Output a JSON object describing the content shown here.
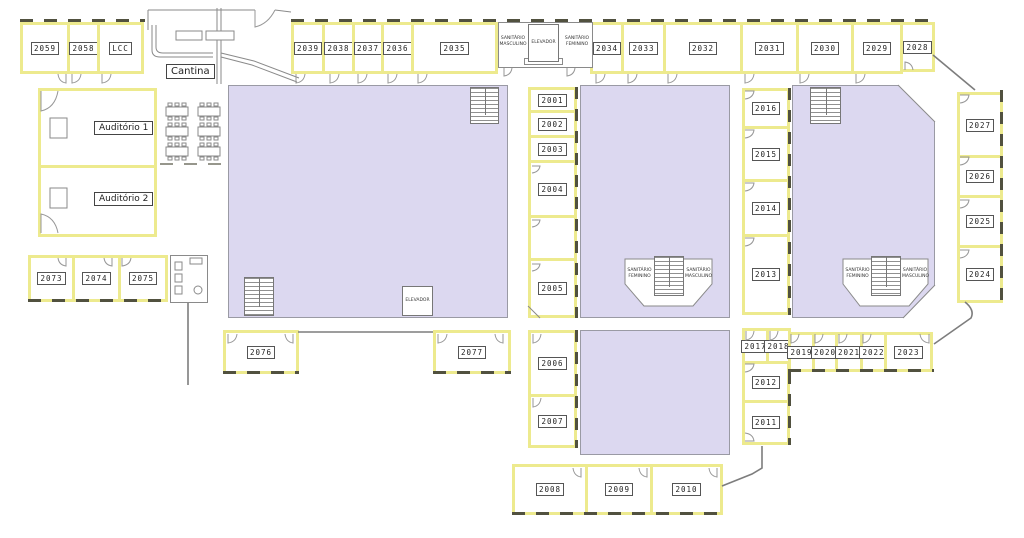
{
  "plan": {
    "rooms": {
      "2001": "2001",
      "2002": "2002",
      "2003": "2003",
      "2004": "2004",
      "2005": "2005",
      "2006": "2006",
      "2007": "2007",
      "2008": "2008",
      "2009": "2009",
      "2010": "2010",
      "2011": "2011",
      "2012": "2012",
      "2013": "2013",
      "2014": "2014",
      "2015": "2015",
      "2016": "2016",
      "2017": "2017",
      "2018": "2018",
      "2019": "2019",
      "2020": "2020",
      "2021": "2021",
      "2022": "2022",
      "2023": "2023",
      "2024": "2024",
      "2025": "2025",
      "2026": "2026",
      "2027": "2027",
      "2028": "2028",
      "2029": "2029",
      "2030": "2030",
      "2031": "2031",
      "2032": "2032",
      "2033": "2033",
      "2034": "2034",
      "2035": "2035",
      "2036": "2036",
      "2037": "2037",
      "2038": "2038",
      "2039": "2039",
      "2058": "2058",
      "2059": "2059",
      "2073": "2073",
      "2074": "2074",
      "2075": "2075",
      "2076": "2076",
      "2077": "2077",
      "lcc": "LCC"
    },
    "areas": {
      "cantina": "Cantina",
      "auditorio1": "Auditório 1",
      "auditorio2": "Auditório 2",
      "elevador": "ELEVADOR",
      "sanitario_masculino": "SANITÁRIO MASCULINO",
      "sanitario_feminino": "SANITÁRIO FEMININO"
    },
    "colors": {
      "wall_yellow": "#edea8e",
      "open_area_fill": "#dcd8f0",
      "line_gray": "#7d7d7d",
      "dash_dark": "#51513f",
      "label_border": "#555555"
    }
  }
}
